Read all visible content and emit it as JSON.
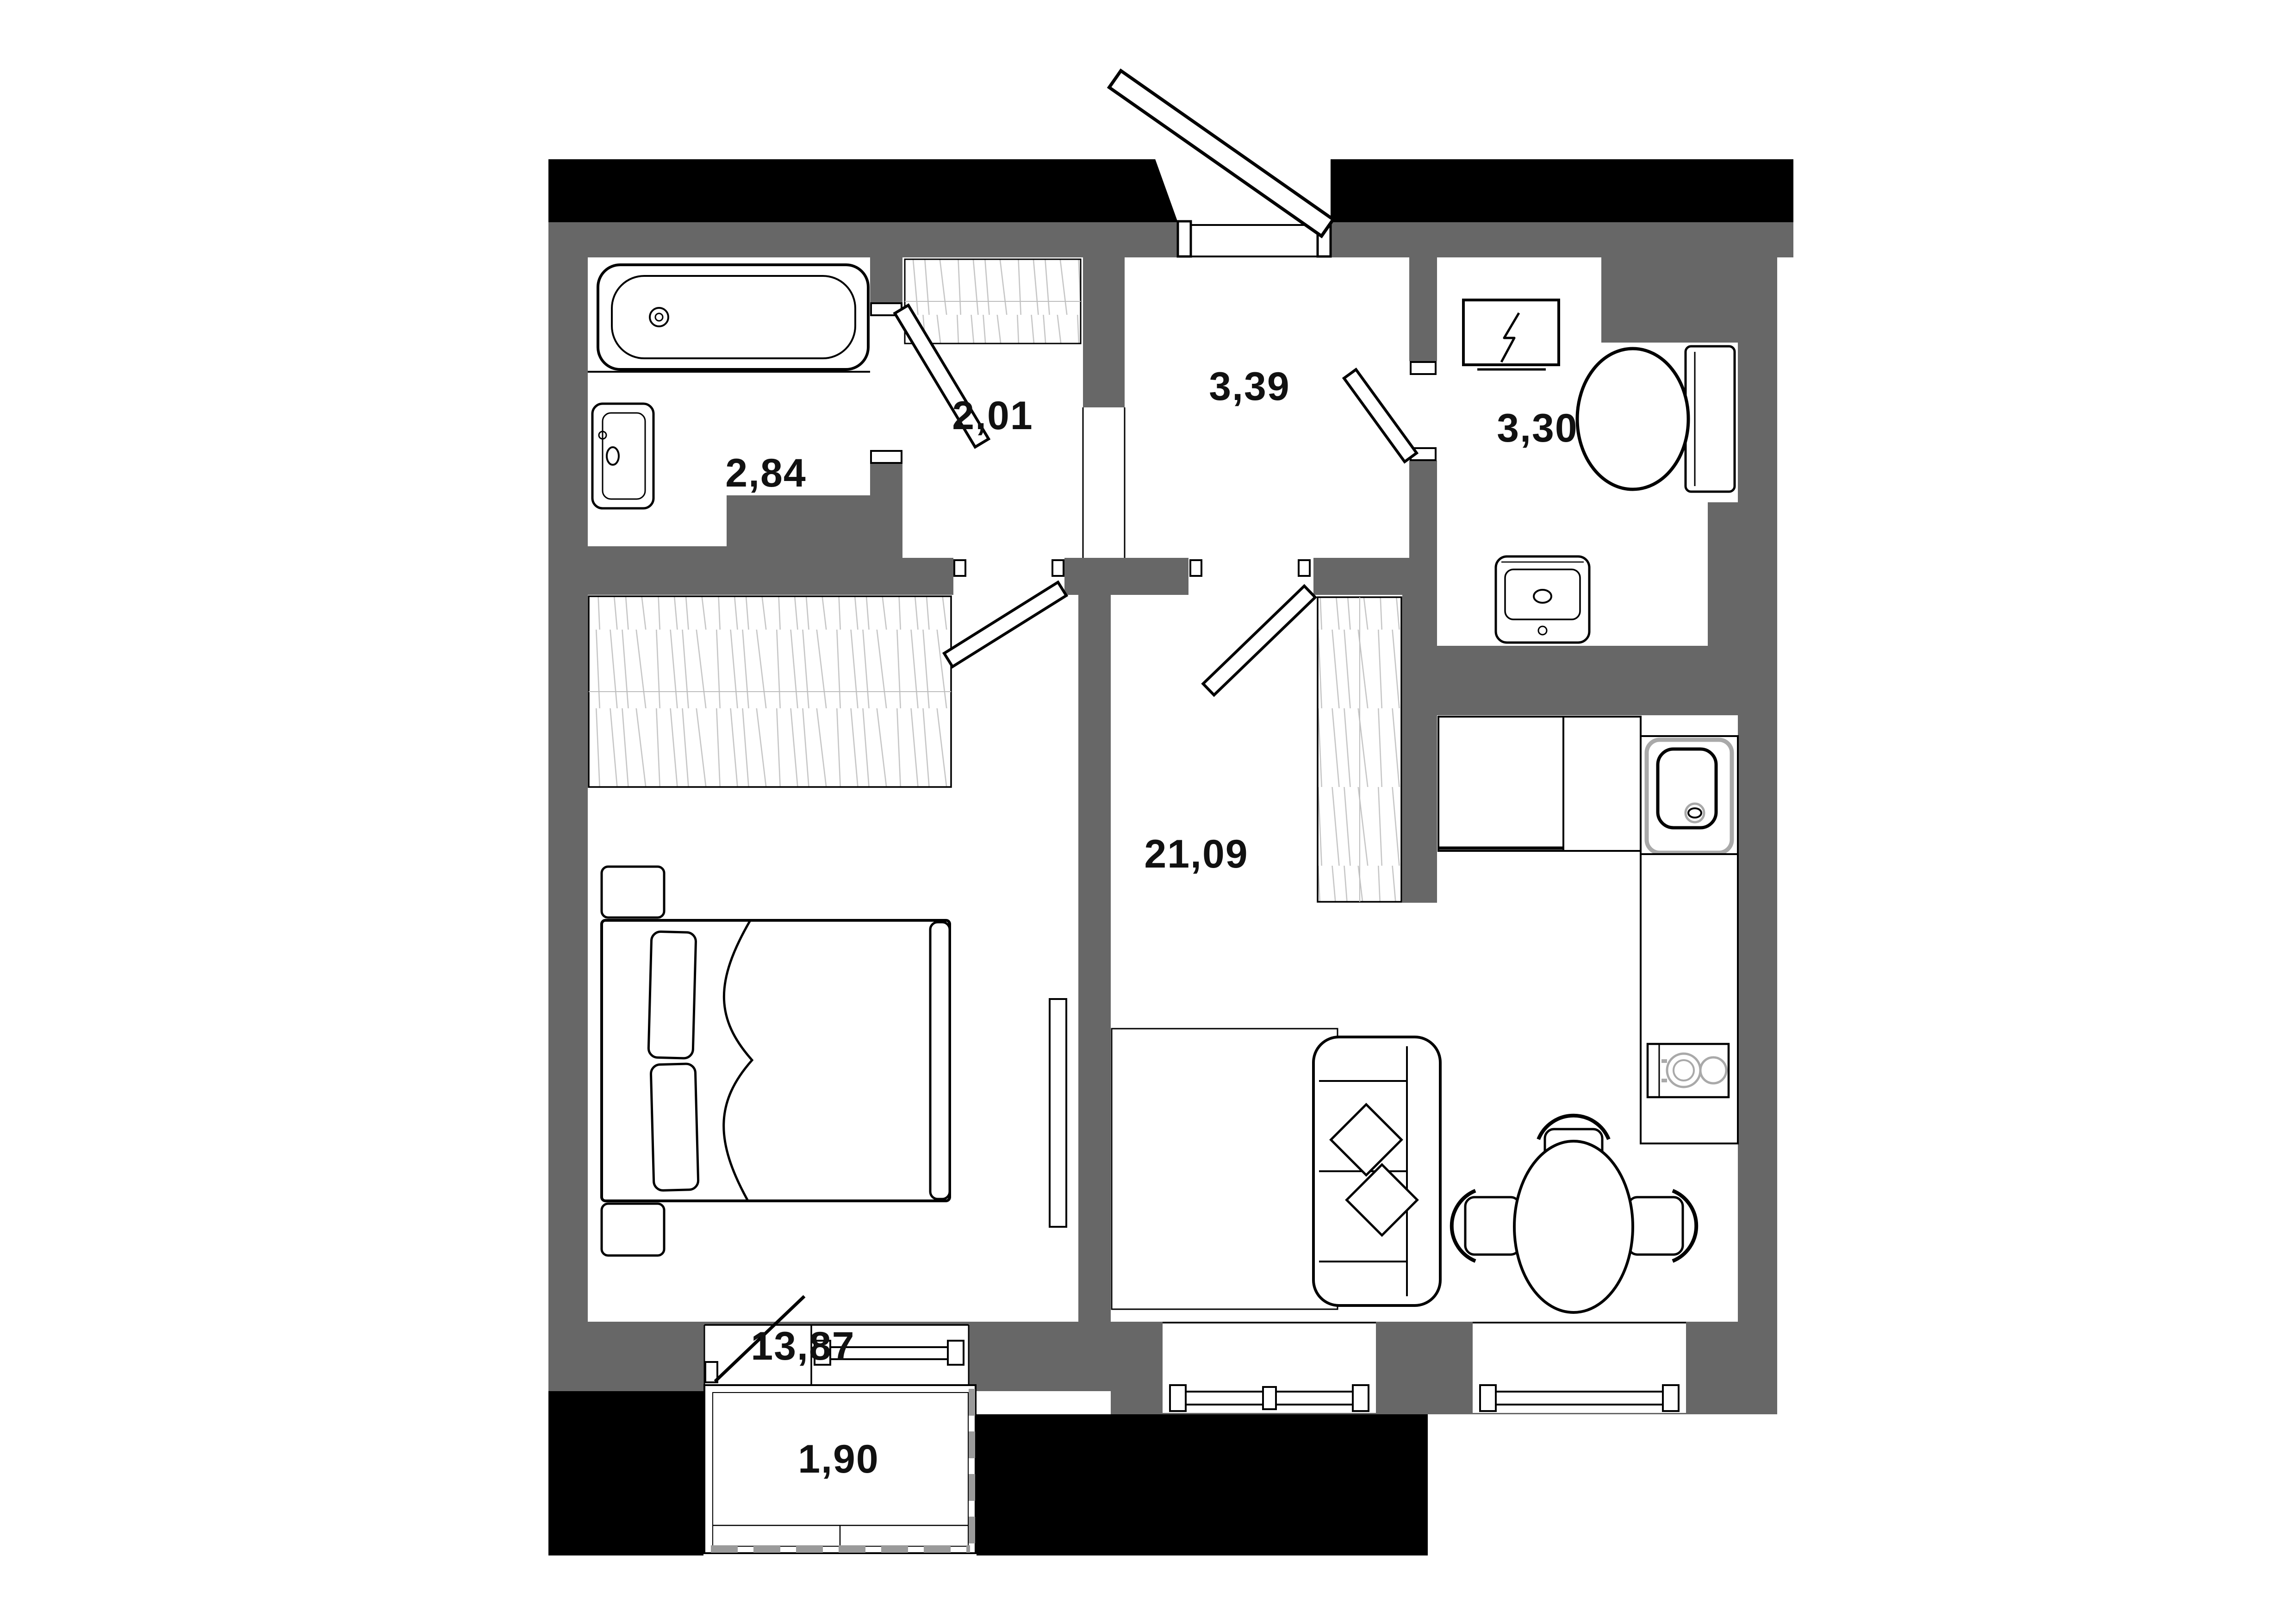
{
  "plan": {
    "type": "apartment-floor-plan",
    "units": "m2",
    "rooms": [
      {
        "id": "bathroom",
        "area_label": "2,84"
      },
      {
        "id": "hall-closet",
        "area_label": "2,01"
      },
      {
        "id": "entry-hall",
        "area_label": "3,39"
      },
      {
        "id": "toilet",
        "area_label": "3,30"
      },
      {
        "id": "living-kitchen",
        "area_label": "21,09"
      },
      {
        "id": "bedroom",
        "area_label": "13,87"
      },
      {
        "id": "balcony",
        "area_label": "1,90"
      }
    ],
    "fixtures": [
      "bathtub",
      "bathroom-sink",
      "electrical-panel",
      "toilet-bowl",
      "toilet-sink",
      "kitchen-counter",
      "kitchen-sink",
      "cooktop",
      "wardrobe-hatch-x3",
      "sofa",
      "pillows",
      "rug",
      "dining-table",
      "dining-chairs-x3",
      "double-bed",
      "nightstands-x2",
      "tv",
      "balcony-glazing",
      "entrance-door",
      "interior-doors-x4",
      "windows-x3",
      "balcony-door"
    ],
    "colors": {
      "background": "#ffffff",
      "wall": "#676767",
      "facade_band": "#000000",
      "outline": "#000000",
      "hatch": "#c6c6c6",
      "accent_gray": "#a9a9a9",
      "label": "#111111"
    }
  }
}
